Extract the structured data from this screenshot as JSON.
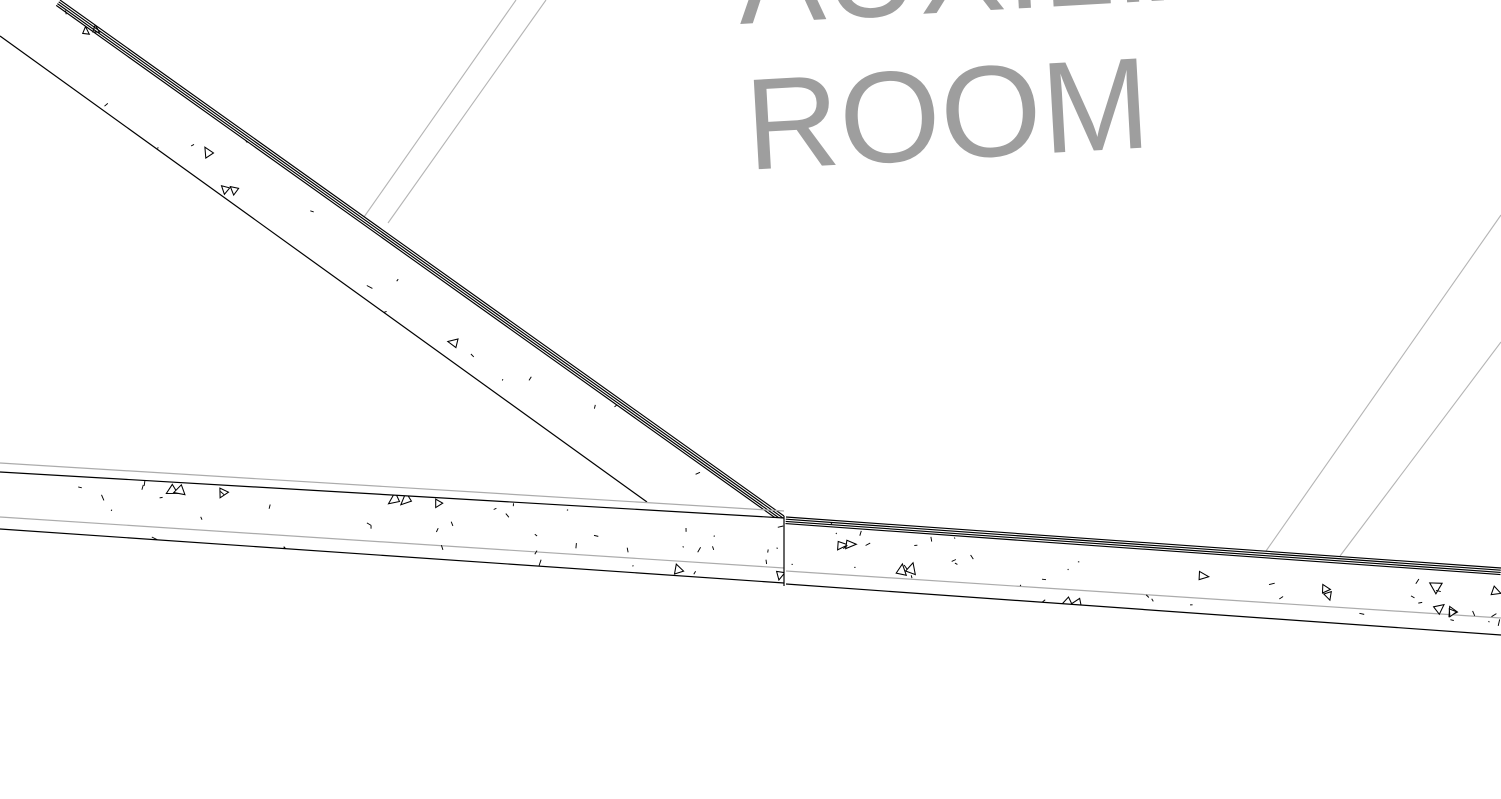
{
  "view": {
    "type": "architectural-cad-drawing",
    "width_px": 1501,
    "height_px": 799,
    "background": "#ffffff"
  },
  "room_label": {
    "full_text": "AUXILIARY ROOM",
    "lines": [
      "AUXILIARY",
      "ROOM"
    ],
    "color": "#9e9e9e",
    "rotation_deg": -3.2
  },
  "colors": {
    "wall_line": "#000000",
    "layer_line": "#ababab",
    "underlay_line": "#b4b4b4",
    "hatch_mark": "#000000",
    "wall_fill": "#ffffff",
    "label_text": "#9e9e9e"
  },
  "walls": [
    {
      "id": "diagonal-wall",
      "description": "concrete wall, diagonal run from upper-left",
      "hatch_pattern": "concrete-stipple"
    },
    {
      "id": "floor-wall-left",
      "description": "concrete wall, left horizontal run",
      "hatch_pattern": "concrete-stipple"
    },
    {
      "id": "floor-wall-right",
      "description": "concrete wall, right horizontal run",
      "hatch_pattern": "concrete-stipple"
    }
  ],
  "reference_lines": {
    "count": 4,
    "description": "thin gray underlay reference lines at ~55 degrees"
  }
}
